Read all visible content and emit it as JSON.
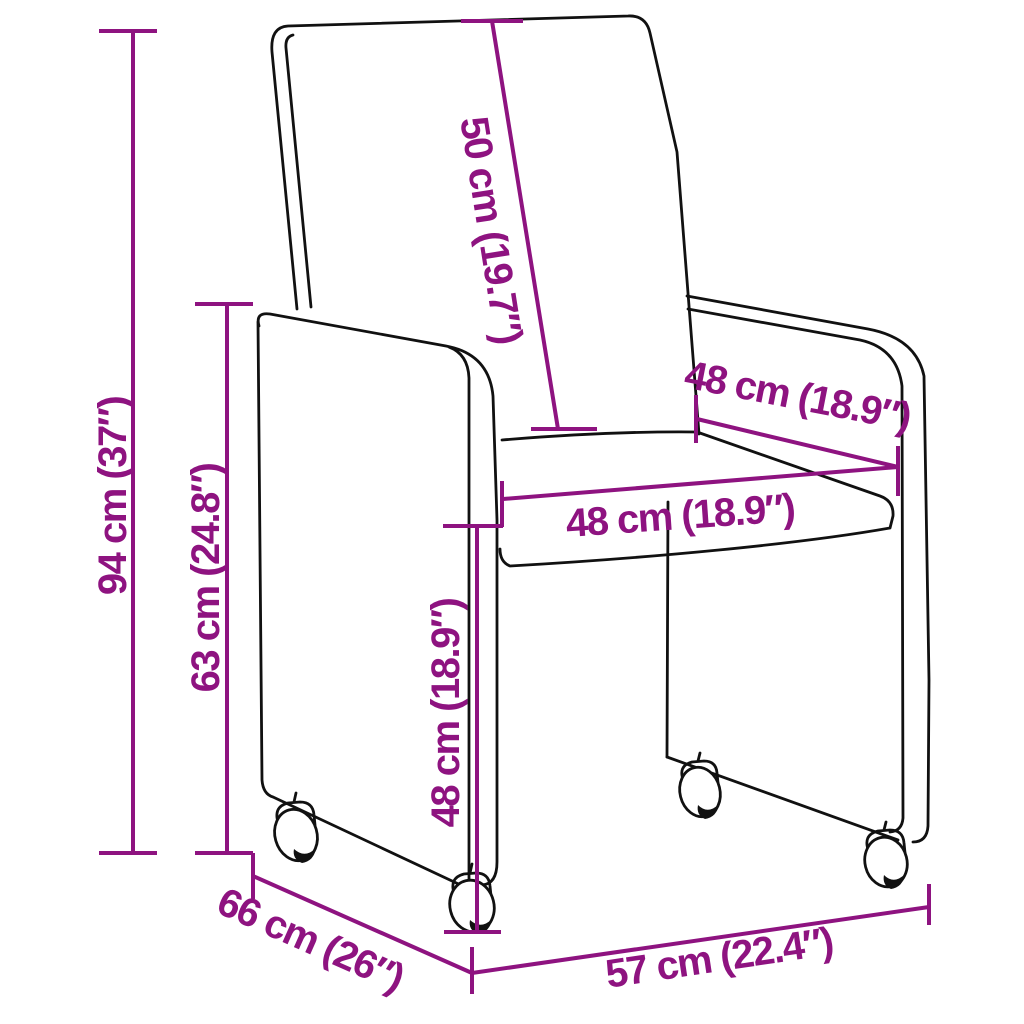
{
  "figure": {
    "type": "product-dimension-diagram",
    "subject": "upholstered armchair with casters",
    "background_color": "#ffffff",
    "outline_color": "#111111",
    "annotation_color": "#8E1380"
  },
  "dimensions": [
    {
      "name": "overall-height",
      "label": "94 cm (37″)",
      "cm": 94,
      "inches": 37
    },
    {
      "name": "arm-height",
      "label": "63 cm (24.8″)",
      "cm": 63,
      "inches": 24.8
    },
    {
      "name": "backrest-length",
      "label": "50 cm (19.7″)",
      "cm": 50,
      "inches": 19.7
    },
    {
      "name": "seat-width-back",
      "label": "48 cm (18.9″)",
      "cm": 48,
      "inches": 18.9
    },
    {
      "name": "seat-depth",
      "label": "48 cm (18.9″)",
      "cm": 48,
      "inches": 18.9
    },
    {
      "name": "seat-height",
      "label": "48 cm (18.9″)",
      "cm": 48,
      "inches": 18.9
    },
    {
      "name": "overall-depth",
      "label": "66 cm (26″)",
      "cm": 66,
      "inches": 26
    },
    {
      "name": "overall-width",
      "label": "57 cm (22.4″)",
      "cm": 57,
      "inches": 22.4
    }
  ]
}
